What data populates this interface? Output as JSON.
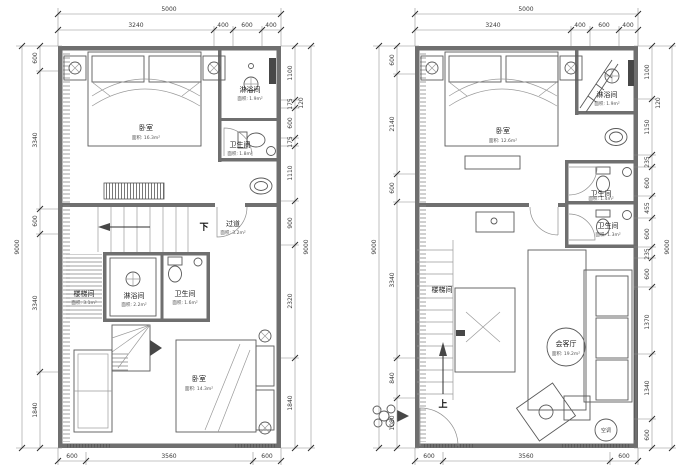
{
  "colors": {
    "wall": "#6f6f6f",
    "line": "#4f4f4f",
    "dim_text": "#3a3a3a",
    "background": "#ffffff"
  },
  "left_plan": {
    "dims": {
      "top_outer": "5000",
      "top_chain": [
        "3240",
        "400",
        "600",
        "400"
      ],
      "left_outer": "9000",
      "left_chain": [
        "600",
        "3340",
        "600",
        "3340",
        "1840"
      ],
      "right_chain": [
        "1100",
        "175",
        "600",
        "175",
        "1110",
        "900",
        "2320",
        "1840"
      ],
      "right_nested": "120",
      "right_outer": "9000",
      "bottom_chain": [
        "600",
        "3560",
        "600"
      ]
    },
    "rooms": {
      "bedroom_top": {
        "name": "卧室",
        "area": "面积: 16.3m²"
      },
      "shower_top": {
        "name": "淋浴间",
        "area": "面积: 1.9m²"
      },
      "toilet_top": {
        "name": "卫生间",
        "area": "面积: 1.8m²"
      },
      "corridor": {
        "name": "过道",
        "area": "面积: 3.2m²"
      },
      "stairwell": {
        "name": "楼梯间",
        "area": "面积: 3.1m²"
      },
      "shower_mid": {
        "name": "淋浴间",
        "area": "面积: 2.2m²"
      },
      "toilet_mid": {
        "name": "卫生间",
        "area": "面积: 1.6m²"
      },
      "bedroom_bottom": {
        "name": "卧室",
        "area": "面积: 14.3m²"
      }
    },
    "annotations": {
      "down": "下"
    }
  },
  "right_plan": {
    "dims": {
      "top_outer": "5000",
      "top_chain": [
        "3240",
        "400",
        "600",
        "400"
      ],
      "left_outer": "9000",
      "left_chain": [
        "600",
        "2140",
        "600",
        "3340",
        "840",
        "1080"
      ],
      "right_chain": [
        "1100",
        "1150",
        "235",
        "600",
        "455",
        "600",
        "235",
        "600",
        "1370",
        "1340",
        "600"
      ],
      "right_nested": "120",
      "right_outer": "9000",
      "bottom_chain": [
        "600",
        "3560",
        "600"
      ]
    },
    "rooms": {
      "bedroom": {
        "name": "卧室",
        "area": "面积: 12.6m²"
      },
      "shower": {
        "name": "淋浴间",
        "area": "面积: 1.9m²"
      },
      "toilet_upper": {
        "name": "卫生间",
        "area": "面积: 1.4m²"
      },
      "toilet_lower": {
        "name": "卫生间",
        "area": "面积: 1.3m²"
      },
      "stairwell": {
        "name": "楼梯间"
      },
      "living": {
        "name": "会客厅",
        "area": "面积: 19.2m²"
      }
    },
    "annotations": {
      "up": "上",
      "ac": "空调"
    }
  }
}
